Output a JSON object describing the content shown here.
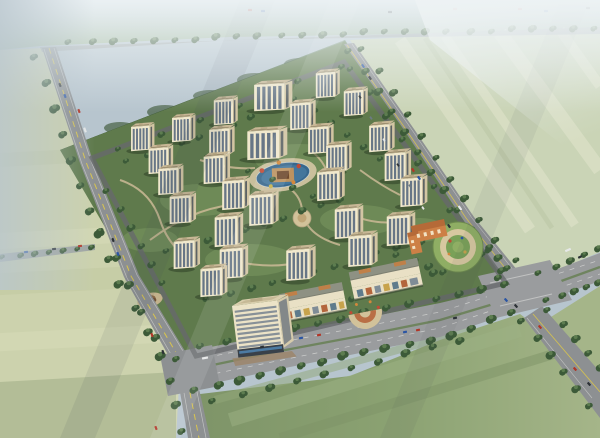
{
  "meta": {
    "image_type": "aerial bird's-eye 3D masterplan rendering",
    "description": "Perspective rendering of a gated residential community: ~29 cream mid-rise apartment towers around a central blue pool garden, bounded by tree-lined roads and pale farmland, with a south commercial strip, an office tower, and a kindergarten with circular playground.",
    "canvas": {
      "width": 600,
      "height": 438
    },
    "visible_text": "none"
  },
  "colors": {
    "haze": "#b7c5ce",
    "hazeLight": "#e8eff2",
    "fieldTop": "#9cb591",
    "fieldTR": "#cad4b6",
    "fieldTRstripe": "#dde2c8",
    "fieldLeft": "#ccd2ad",
    "fieldLeftStripe": "#d8dcb8",
    "fieldLeftLow": "#aeba93",
    "fieldBottom": "#8ba272",
    "fieldBottomDark": "#7e9468",
    "fieldRight": "#a5b589",
    "forestDark": "#46633f",
    "forestHaze": "#76927a",
    "forestBlob": "#3d5838",
    "siteGreen": "#5f7a4c",
    "lawn": "#7d9a62",
    "road": "#8d9092",
    "roadLight": "#9a9c9e",
    "roadYellow": "#d8c44e",
    "innerRoad": "#66696b",
    "median": "#6a8258",
    "path": "#ccba96",
    "plaza": "#d2c29a",
    "treeDark": "#3c5a38",
    "treeLight": "#5d7d50",
    "twFront": "#f0e8cd",
    "twSide": "#d2c5a3",
    "twGlass": "#5c6d80",
    "twRoof": "#c7b795",
    "twRidge": "#8a7d61",
    "twRoofBox": "#b3a481",
    "officeFace": "#ece3c7",
    "officeBand": "#76828f",
    "officeRoof": "#d9cead",
    "retailRoof": "#8e9183",
    "retailWall": "#e9e0c5",
    "kgOrange": "#cd8046",
    "kgRoof": "#b56a38",
    "pgGreen": "#8fae64",
    "pgTrack": "#d7c8a0",
    "pgInner": "#7aa158",
    "water": "#37678c",
    "waterLight": "#4a7ea5",
    "island": "#bb9260",
    "brick": "#a06a4e",
    "carRed": "#b23527",
    "carBlue": "#2a55a4",
    "carDark": "#2c3136",
    "carWhite": "#e6e8e8"
  },
  "scene": {
    "towers": [
      [
        272,
        112,
        0.85,
        1.5
      ],
      [
        327,
        99,
        0.8,
        1
      ],
      [
        355,
        117,
        0.8,
        1
      ],
      [
        225,
        126,
        0.8,
        1
      ],
      [
        302,
        131,
        0.85,
        1
      ],
      [
        183,
        143,
        0.78,
        1
      ],
      [
        142,
        152,
        0.78,
        1
      ],
      [
        221,
        157,
        0.85,
        1
      ],
      [
        266,
        161,
        0.92,
        1.45
      ],
      [
        320,
        155,
        0.85,
        1
      ],
      [
        381,
        153,
        0.85,
        1
      ],
      [
        160,
        175,
        0.82,
        1
      ],
      [
        338,
        173,
        0.85,
        1
      ],
      [
        397,
        182,
        0.88,
        1
      ],
      [
        216,
        185,
        0.88,
        1
      ],
      [
        170,
        196,
        0.84,
        1
      ],
      [
        235,
        211,
        0.92,
        1
      ],
      [
        330,
        202,
        0.92,
        1
      ],
      [
        413,
        208,
        0.9,
        1
      ],
      [
        182,
        225,
        0.88,
        1
      ],
      [
        263,
        227,
        0.98,
        1
      ],
      [
        348,
        240,
        0.95,
        1
      ],
      [
        228,
        248,
        0.95,
        1
      ],
      [
        400,
        247,
        0.95,
        1
      ],
      [
        186,
        270,
        0.88,
        1
      ],
      [
        233,
        280,
        0.95,
        1
      ],
      [
        300,
        282,
        0.98,
        1
      ],
      [
        362,
        268,
        0.98,
        1
      ],
      [
        213,
        298,
        0.9,
        1
      ]
    ],
    "treelines": [
      {
        "p": [
          [
            70,
            43
          ],
          [
            340,
            33
          ],
          [
            595,
            28
          ]
        ],
        "n": 26,
        "r": 3
      },
      {
        "p": [
          [
            36,
            58
          ],
          [
            72,
            164
          ],
          [
            118,
            279
          ],
          [
            168,
            371
          ],
          [
            182,
            432
          ]
        ],
        "n": 16,
        "r": 3.6
      },
      {
        "p": [
          [
            102,
            232
          ],
          [
            150,
            332
          ],
          [
            176,
            358
          ]
        ],
        "n": 6,
        "r": 3.3
      },
      {
        "p": [
          [
            202,
            347
          ],
          [
            300,
            326
          ],
          [
            420,
            302
          ],
          [
            504,
            283
          ]
        ],
        "n": 14,
        "r": 3.5
      },
      {
        "p": [
          [
            196,
            391
          ],
          [
            300,
            365
          ],
          [
            440,
            338
          ],
          [
            512,
            313
          ]
        ],
        "n": 16,
        "r": 3.8
      },
      {
        "p": [
          [
            214,
            402
          ],
          [
            330,
            372
          ],
          [
            462,
            341
          ]
        ],
        "n": 10,
        "r": 3.3
      },
      {
        "p": [
          [
            540,
            274
          ],
          [
            598,
            248
          ]
        ],
        "n": 5,
        "r": 3
      },
      {
        "p": [
          [
            548,
            301
          ],
          [
            598,
            282
          ]
        ],
        "n": 5,
        "r": 3
      },
      {
        "p": [
          [
            350,
            52
          ],
          [
            410,
            140
          ],
          [
            470,
            226
          ],
          [
            500,
            270
          ]
        ],
        "n": 12,
        "r": 3.2
      },
      {
        "p": [
          [
            363,
            50
          ],
          [
            423,
            138
          ],
          [
            483,
            224
          ],
          [
            514,
            260
          ]
        ],
        "n": 11,
        "r": 3
      },
      {
        "p": [
          [
            523,
            322
          ],
          [
            589,
            405
          ]
        ],
        "n": 6,
        "r": 3.4
      },
      {
        "p": [
          [
            549,
            311
          ],
          [
            600,
            367
          ]
        ],
        "n": 5,
        "r": 3.2
      },
      {
        "p": [
          [
            4,
            258
          ],
          [
            92,
            246
          ]
        ],
        "n": 7,
        "r": 2.5
      },
      {
        "p": [
          [
            128,
            162
          ],
          [
            252,
            118
          ]
        ],
        "n": 8,
        "r": 2.7
      },
      {
        "p": [
          [
            168,
            252
          ],
          [
            342,
            200
          ]
        ],
        "n": 10,
        "r": 2.9
      },
      {
        "p": [
          [
            208,
            300
          ],
          [
            420,
            242
          ]
        ],
        "n": 11,
        "r": 3
      },
      {
        "p": [
          [
            242,
            330
          ],
          [
            462,
            266
          ]
        ],
        "n": 9,
        "r": 3
      },
      {
        "p": [
          [
            108,
            192
          ],
          [
            162,
            282
          ]
        ],
        "n": 6,
        "r": 3
      },
      {
        "p": [
          [
            296,
            100
          ],
          [
            380,
            158
          ]
        ],
        "n": 6,
        "r": 2.7
      },
      {
        "p": [
          [
            250,
            172
          ],
          [
            312,
            196
          ]
        ],
        "n": 4,
        "r": 2.5
      },
      {
        "p": [
          [
            398,
            256
          ],
          [
            442,
            272
          ]
        ],
        "n": 4,
        "r": 3
      },
      {
        "p": [
          [
            478,
            238
          ],
          [
            506,
            268
          ]
        ],
        "n": 4,
        "r": 3
      },
      {
        "p": [
          [
            120,
            150
          ],
          [
            340,
            66
          ]
        ],
        "n": 12,
        "r": 2.6
      },
      {
        "p": [
          [
            352,
            70
          ],
          [
            500,
            278
          ]
        ],
        "n": 10,
        "r": 2.8
      }
    ],
    "cars": [
      [
        60,
        85,
        "dk",
        70
      ],
      [
        65,
        96,
        "bl",
        70
      ],
      [
        79,
        111,
        "rd",
        70
      ],
      [
        85,
        130,
        "wt",
        70,
        5
      ],
      [
        113,
        240,
        "dk",
        70
      ],
      [
        118,
        254,
        "bl",
        70
      ],
      [
        152,
        335,
        "rd",
        70
      ],
      [
        163,
        352,
        "dk",
        70
      ],
      [
        156,
        428,
        "rd",
        70
      ],
      [
        205,
        358,
        "wt",
        -11,
        6
      ],
      [
        262,
        347,
        "dk",
        -11
      ],
      [
        301,
        338,
        "bl",
        -11
      ],
      [
        319,
        335,
        "rd",
        -11
      ],
      [
        405,
        332,
        "bl",
        -11
      ],
      [
        418,
        330,
        "rd",
        -11
      ],
      [
        455,
        318,
        "dk",
        -11
      ],
      [
        363,
        66,
        "bl",
        56
      ],
      [
        370,
        78,
        "dk",
        56
      ],
      [
        413,
        170,
        "rd",
        56
      ],
      [
        419,
        178,
        "bl",
        56
      ],
      [
        449,
        226,
        "dk",
        56
      ],
      [
        460,
        208,
        "wt",
        56,
        5
      ],
      [
        506,
        300,
        "bl",
        48
      ],
      [
        516,
        306,
        "dk",
        48
      ],
      [
        540,
        327,
        "rd",
        48
      ],
      [
        575,
        369,
        "rd",
        48
      ],
      [
        589,
        384,
        "dk",
        48
      ],
      [
        568,
        250,
        "wt",
        -24,
        6
      ],
      [
        580,
        257,
        "dk",
        -24
      ],
      [
        250,
        10,
        "rd",
        0
      ],
      [
        263,
        11,
        "bl",
        0
      ],
      [
        390,
        12,
        "dk",
        0
      ],
      [
        455,
        9,
        "rd",
        0
      ],
      [
        520,
        9,
        "rd",
        0
      ],
      [
        546,
        11,
        "bl",
        0
      ],
      [
        588,
        8,
        "dk",
        0
      ],
      [
        26,
        252,
        "bl",
        -6
      ],
      [
        54,
        249,
        "dk",
        -6
      ],
      [
        80,
        246,
        "rd",
        -6
      ]
    ],
    "parked_cars": [
      [
        360,
        97
      ],
      [
        371,
        118
      ],
      [
        384,
        140
      ],
      [
        398,
        165
      ],
      [
        410,
        186
      ],
      [
        423,
        208
      ]
    ],
    "landmarks": {
      "central_pool": "kidney-shaped blue pool with tan island pavilion at community center",
      "office_tower": "10-storey cream office block with dark glass base, south-west corner",
      "retail_strips": "two 2-3 storey arcade retail rows along the south boulevard",
      "gate_plaza": "fan-shaped terraced entry plaza on the boulevard",
      "kindergarten": "orange kindergarten with circular green playground, south-east corner",
      "roads": "tree-lined perimeter roads with a wide south boulevard and two intersections"
    }
  }
}
